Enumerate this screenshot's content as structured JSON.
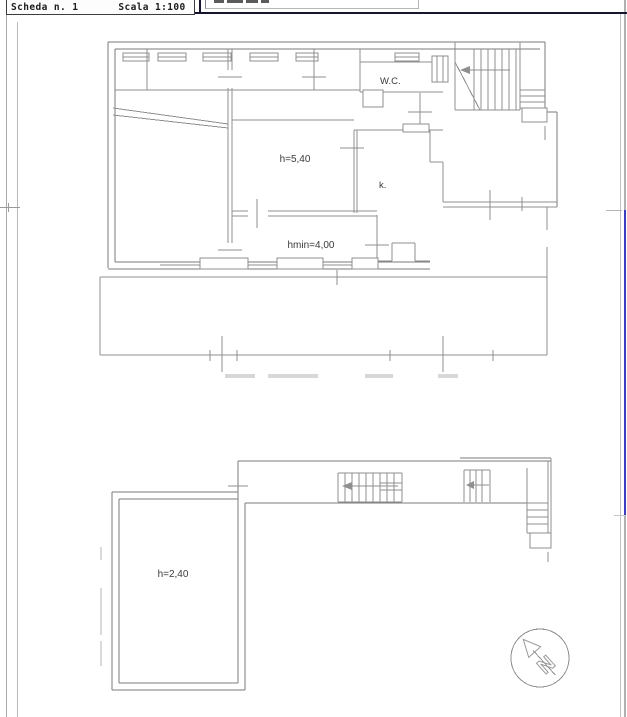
{
  "header": {
    "scheda": "Scheda n. 1",
    "scala": "Scala 1:100"
  },
  "plan": {
    "upper": {
      "wc_label": "W.C.",
      "height_label": "h=5,40",
      "kitchen_label": "k.",
      "hmin_label": "hmin=4,00"
    },
    "lower": {
      "height_label": "h=2,40"
    },
    "compass_letter": "N"
  },
  "colors": {
    "plan_line": "#8f8f8f",
    "frame_line": "#a8a8a8",
    "top_rule": "#15152f",
    "accent_blue": "#3b3fc0",
    "label_ink": "#3a3a3a"
  }
}
